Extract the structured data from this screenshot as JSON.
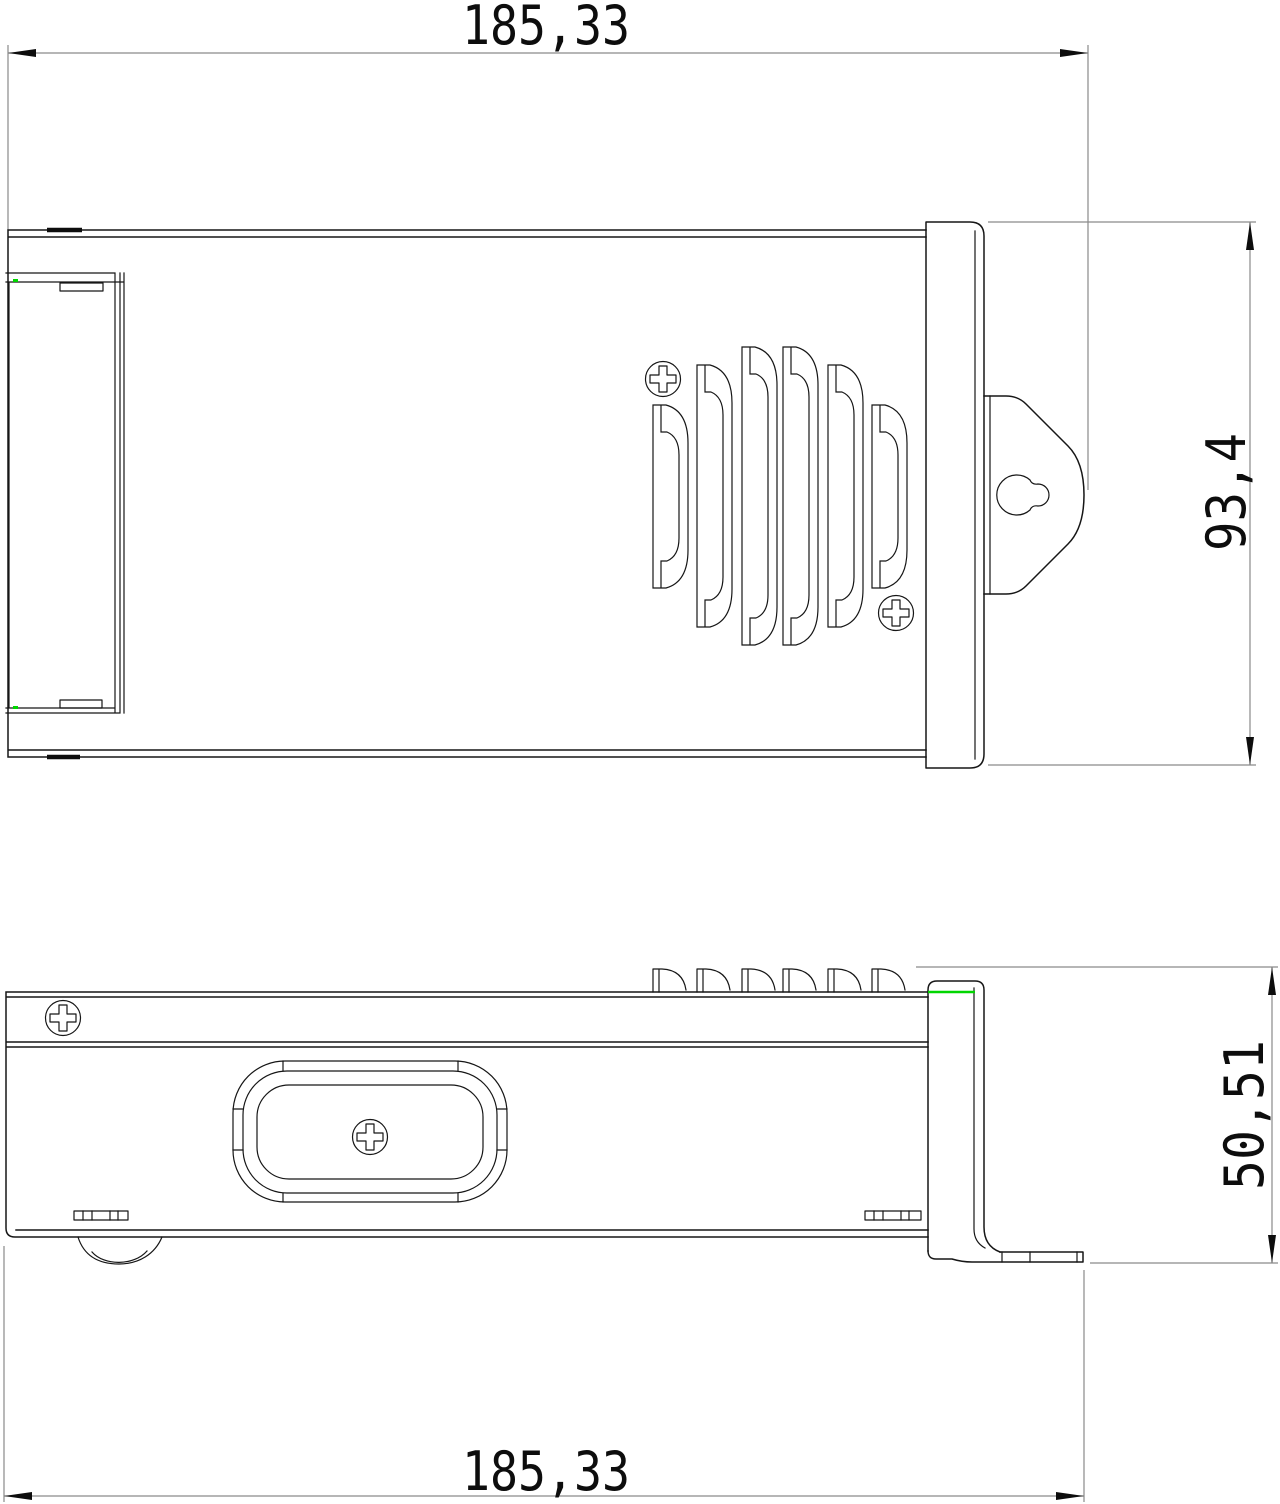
{
  "drawing": {
    "title": "enclosure-two-view-dimensioned-drawing",
    "dimensions": {
      "top_width": "185,33",
      "overall_height": "93,4",
      "side_height": "50,51",
      "bottom_width": "185,33"
    },
    "colors": {
      "object_line": "#161616",
      "dimension_line": "#8a8a8a",
      "dimension_text": "#0d0d0d",
      "accent_green": "#00d600",
      "background": "#ffffff"
    }
  }
}
